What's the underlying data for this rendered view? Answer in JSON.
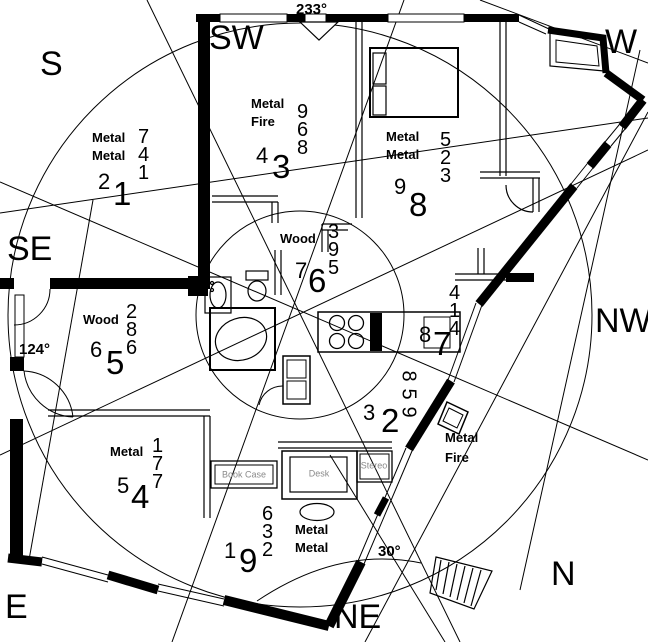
{
  "title": "Feng shui flying-star floor plan",
  "colors": {
    "ink": "#000000",
    "background": "#ffffff",
    "furniture_label": "#8a8a8a"
  },
  "compass": {
    "s": "S",
    "sw": "SW",
    "w": "W",
    "se": "SE",
    "nw": "NW",
    "e": "E",
    "ne": "NE",
    "n": "N"
  },
  "angles": {
    "facing": "233°",
    "side": "124°",
    "stair": "30°"
  },
  "sectors": [
    {
      "name": "south",
      "elements": [
        "Metal",
        "Metal"
      ],
      "stack": [
        "7",
        "4",
        "1"
      ],
      "left": "2",
      "big": "1"
    },
    {
      "name": "southwest",
      "elements": [
        "Metal",
        "Fire"
      ],
      "stack": [
        "9",
        "6",
        "8"
      ],
      "left": "4",
      "big": "3"
    },
    {
      "name": "west",
      "elements": [
        "Metal",
        "Metal"
      ],
      "stack": [
        "5",
        "2",
        "3"
      ],
      "left": "9",
      "big": "8"
    },
    {
      "name": "southeast",
      "elements": [
        "Wood"
      ],
      "stack": [
        "2",
        "8",
        "6"
      ],
      "left": "6",
      "big": "5"
    },
    {
      "name": "center",
      "elements": [
        "Wood"
      ],
      "stack": [
        "3",
        "9",
        "5"
      ],
      "left": "7",
      "big": "6"
    },
    {
      "name": "northwest",
      "elements": [],
      "stack": [
        "4",
        "1",
        "4"
      ],
      "left": "8",
      "big": "7"
    },
    {
      "name": "north-upper",
      "elements": [],
      "stack": [
        "8",
        "5",
        "9"
      ],
      "left": "3",
      "big": "2",
      "stack_rotated": true
    },
    {
      "name": "east",
      "elements": [
        "Metal"
      ],
      "stack": [
        "1",
        "7",
        "7"
      ],
      "left": "5",
      "big": "4"
    },
    {
      "name": "northeast",
      "elements": [
        "Metal",
        "Metal"
      ],
      "stack": [
        "6",
        "3",
        "2"
      ],
      "left": "1",
      "big": "9"
    },
    {
      "name": "northeast-right",
      "elements": [
        "Metal",
        "Fire"
      ],
      "stack": [],
      "left": "",
      "big": ""
    }
  ],
  "furniture": {
    "book_case": "Book Case",
    "desk": "Desk",
    "stereo": "Stereo"
  }
}
